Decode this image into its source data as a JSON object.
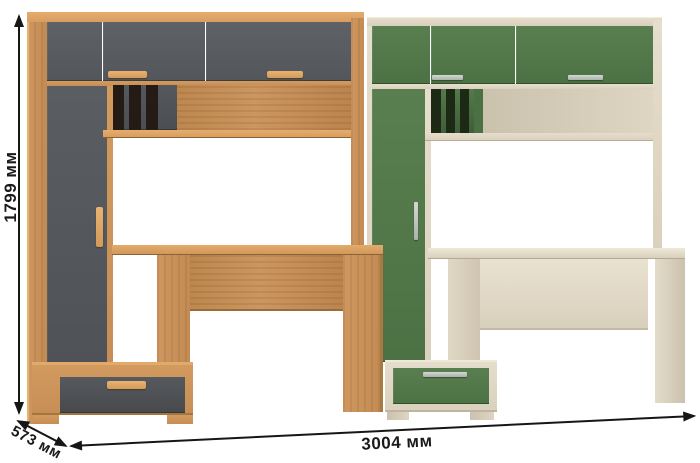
{
  "diagram": {
    "type": "furniture-dimension-diagram",
    "background_color": "#ffffff",
    "annotation_color": "#161616"
  },
  "dimensions": {
    "height": {
      "label": "1799 мм",
      "value_mm": 1799,
      "axis": "height"
    },
    "depth": {
      "label": "573 мм",
      "value_mm": 573,
      "axis": "depth"
    },
    "width": {
      "label": "3004 мм",
      "value_mm": 3004,
      "axis": "width"
    }
  },
  "units": {
    "left_unit": {
      "name": "desk-wall-unit-oak-graphite",
      "frame_color": "#c99157",
      "front_color": "#585c60",
      "handle_color": "#d9a766",
      "shelf_recess_color": "#241c14"
    },
    "right_unit": {
      "name": "desk-wall-unit-cream-green",
      "frame_color": "#dcd3c0",
      "front_color": "#53784a",
      "handle_color": "#b8bdb7",
      "shelf_recess_color": "#1b2915"
    }
  }
}
